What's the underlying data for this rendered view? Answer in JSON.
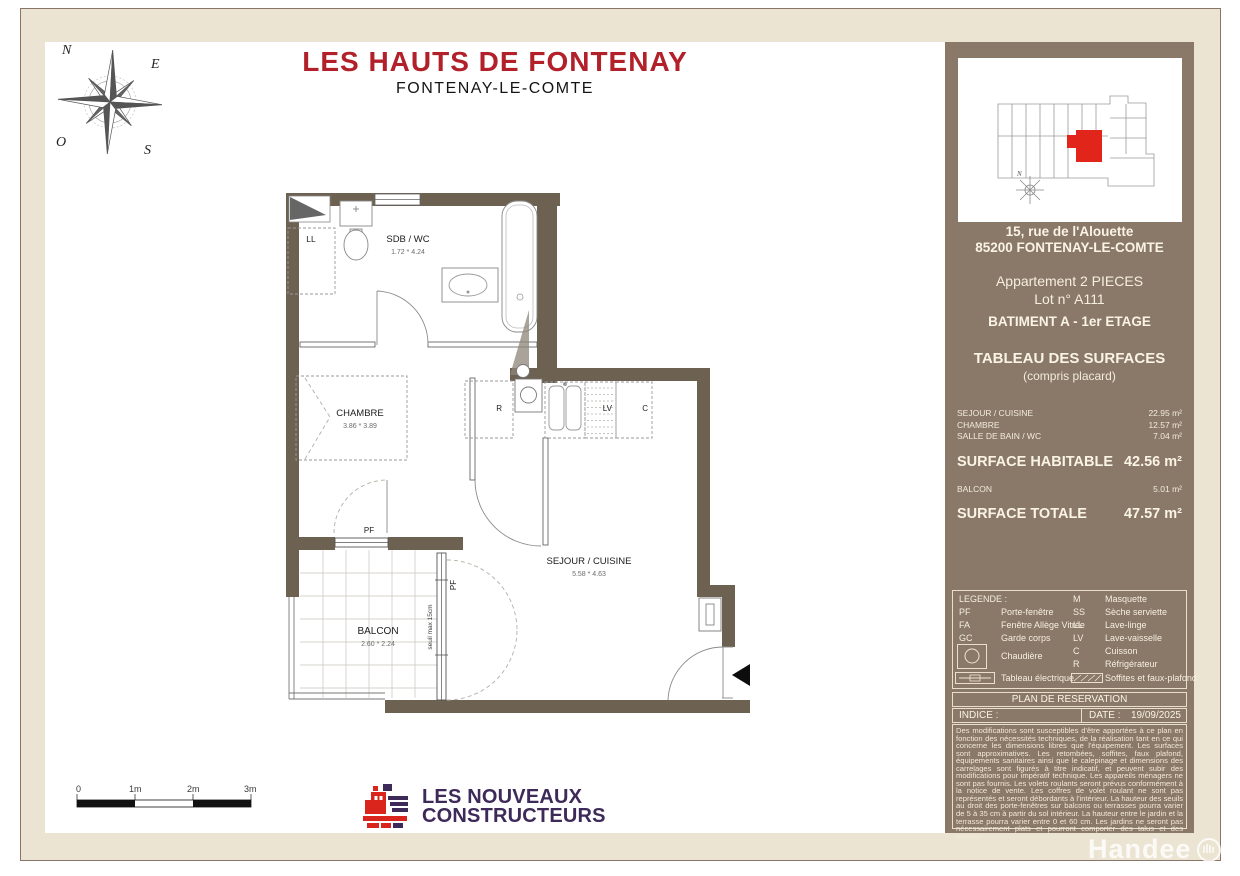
{
  "title": {
    "main": "LES HAUTS DE FONTENAY",
    "sub": "FONTENAY-LE-COMTE"
  },
  "compass": {
    "n": "N",
    "e": "E",
    "s": "S",
    "o": "O"
  },
  "plan": {
    "rooms": [
      {
        "name": "SDB / WC",
        "dims": "1.72 * 4.24"
      },
      {
        "name": "CHAMBRE",
        "dims": "3.86 * 3.89"
      },
      {
        "name": "SEJOUR / CUISINE",
        "dims": "5.58 * 4.63"
      },
      {
        "name": "BALCON",
        "dims": "2.60 * 2.24"
      }
    ],
    "eq": {
      "ll": "LL",
      "r": "R",
      "lv": "LV",
      "c": "C"
    },
    "pf": "PF",
    "seuil": "seuil max 15cm"
  },
  "scale": {
    "t0": "0",
    "t1": "1m",
    "t2": "2m",
    "t3": "3m"
  },
  "logo": {
    "line1": "LES NOUVEAUX",
    "line2": "CONSTRUCTEURS"
  },
  "sidebar": {
    "address_line1": "15, rue de l'Alouette",
    "address_line2": "85200 FONTENAY-LE-COMTE",
    "apartment_line1": "Appartement 2 PIECES",
    "apartment_line2": "Lot n° A111",
    "building": "BATIMENT A - 1er ETAGE",
    "surfaces_title": "TABLEAU DES SURFACES",
    "surfaces_subtitle": "(compris placard)",
    "rows": [
      {
        "label": "SEJOUR / CUISINE",
        "value": "22.95 m²"
      },
      {
        "label": "CHAMBRE",
        "value": "12.57 m²"
      },
      {
        "label": "SALLE DE BAIN / WC",
        "value": "7.04 m²"
      }
    ],
    "habitable": {
      "label": "SURFACE HABITABLE",
      "value": "42.56 m²"
    },
    "balcon": {
      "label": "BALCON",
      "value": "5.01 m²"
    },
    "totale": {
      "label": "SURFACE TOTALE",
      "value": "47.57 m²"
    },
    "legend": {
      "title": "LEGENDE :",
      "left": [
        {
          "k": "PF",
          "v": "Porte-fenêtre"
        },
        {
          "k": "FA",
          "v": "Fenêtre Allège Vitrée"
        },
        {
          "k": "GC",
          "v": "Garde corps"
        }
      ],
      "right": [
        {
          "k": "M",
          "v": "Masquette"
        },
        {
          "k": "SS",
          "v": "Sèche serviette"
        },
        {
          "k": "LL",
          "v": "Lave-linge"
        },
        {
          "k": "LV",
          "v": "Lave-vaisselle"
        },
        {
          "k": "C",
          "v": "Cuisson"
        },
        {
          "k": "R",
          "v": "Réfrigérateur"
        }
      ],
      "chaudiere": "Chaudière",
      "tableau": "Tableau électrique",
      "soffites": "Soffites et faux-plafond"
    },
    "reservation": "PLAN DE RESERVATION",
    "indice_label": "INDICE :",
    "date_label": "DATE :",
    "date_value": "19/09/2025",
    "disclaimer": "Des modifications sont susceptibles d'être apportées à ce plan en fonction des nécessités techniques, de la réalisation tant en ce qui concerne les dimensions libres que l'équipement. Les surfaces sont approximatives. Les retombées, soffites, faux plafond, équipements sanitaires ainsi que le calepinage et dimensions des carrelages sont figurés à titre indicatif, et peuvent subir des modifications pour impératif technique. Les appareils ménagers ne sont pas fournis. Les volets roulants seront prévus conformément à la notice de vente. Les coffres de volet roulant ne sont pas représentés et seront débordants à l'intérieur. La hauteur des seuils au droit des porte-fenêtres sur balcons ou terrasses pourra varier de 5 à 35 cm à partir du sol intérieur. La hauteur entre le jardin et la terrasse pourra varier entre 0 et 60 cm. Les jardins ne seront pas nécessairement plats et pourront comporter des talus et des pentes."
  },
  "watermark": "Handee",
  "colors": {
    "accent_red": "#b2212a",
    "wall": "#6d6152",
    "sidebar": "#8a7869",
    "cream": "#ece4d2",
    "logo_purple": "#3d2a59",
    "unit_red": "#e1251b"
  }
}
